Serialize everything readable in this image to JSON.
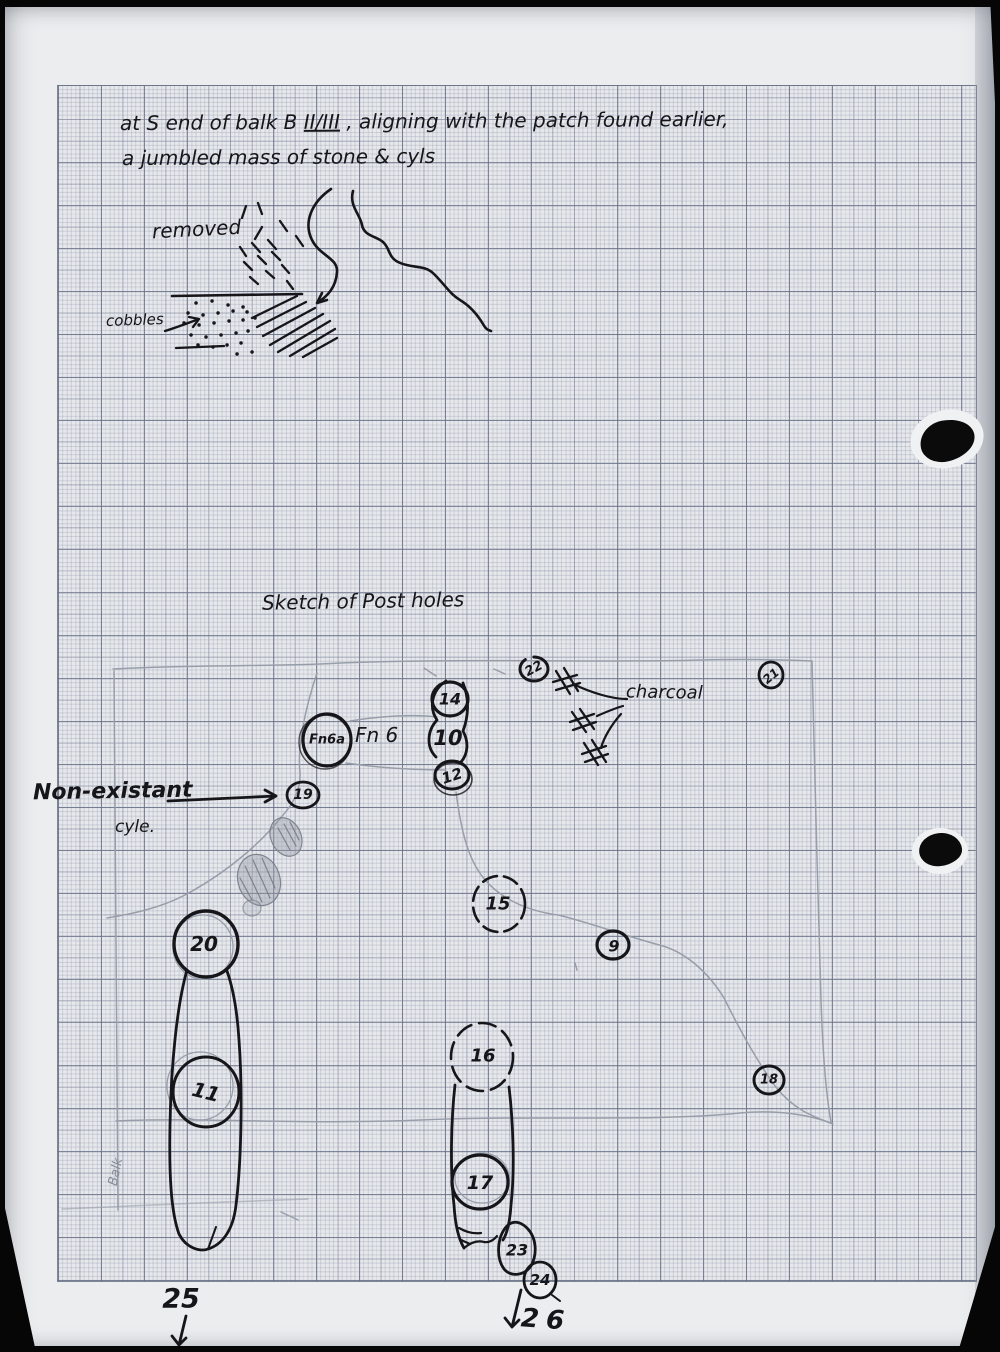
{
  "header_note": {
    "line1_prefix": "at S end of balk B ",
    "line1_levels": "II/III",
    "line1_suffix": " , aligning with the patch found earlier,",
    "line2": "a jumbled mass of stone & cyls"
  },
  "upper_sketch": {
    "removed_label": "removed",
    "cobbles_label": "cobbles"
  },
  "postholes_sketch": {
    "title": "Sketch of Post holes",
    "non_existant_line1": "Non-existant",
    "non_existant_line2": "cyle.",
    "charcoal_label": "charcoal",
    "fn6_label": "Fn 6",
    "fn6a_label": "Fn6a",
    "balk_label": "Balk",
    "holes": {
      "h9": "9",
      "h10": "10",
      "h11": "11",
      "h12": "12",
      "h14": "14",
      "h15": "15",
      "h16": "16",
      "h17": "17",
      "h18": "18",
      "h19": "19",
      "h20": "20",
      "h21": "21",
      "h22": "22",
      "h23": "23",
      "h24": "24"
    },
    "margin_labels": {
      "left": "25",
      "right": "26"
    }
  },
  "colors": {
    "ink": "#15151a",
    "pencil": "#9ba1ab",
    "paper": "#ebedef"
  }
}
